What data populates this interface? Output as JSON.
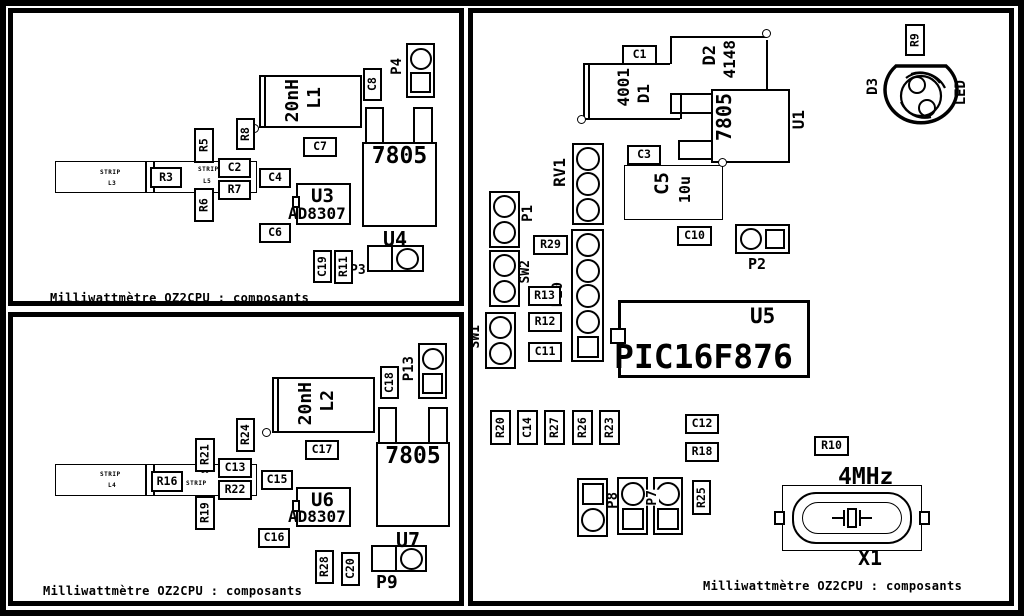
{
  "colors": {
    "line": "#000000",
    "background": "#ffffff"
  },
  "caption": "Milliwattmètre OZ2CPU : composants",
  "panel_tl": {
    "strip": {
      "line1": "STRIP",
      "line2": "L3"
    },
    "strip_small": {
      "line1": "STRIP",
      "line2": "L5"
    },
    "r3": "R3",
    "r5": "R5",
    "r6": "R6",
    "c2": "C2",
    "r7": "R7",
    "c4": "C4",
    "r8": "R8",
    "l1_value": "20nH",
    "l1_ref": "L1",
    "c7": "C7",
    "c8": "C8",
    "p4": "P4",
    "regulator": "7805",
    "u3_ref": "U3",
    "u3_value": "AD8307",
    "c6": "C6",
    "u4": "U4",
    "c19": "C19",
    "r11": "R11",
    "p3": "P3"
  },
  "panel_bl": {
    "strip": {
      "line1": "STRIP",
      "line2": "L4"
    },
    "strip_small": {
      "line1": "L6",
      "line2": "STRIP"
    },
    "r16": "R16",
    "r21": "R21",
    "r19": "R19",
    "c13": "C13",
    "r22": "R22",
    "r24": "R24",
    "c15": "C15",
    "l2_value": "20nH",
    "l2_ref": "L2",
    "c17": "C17",
    "c18": "C18",
    "p13": "P13",
    "regulator": "7805",
    "u6_ref": "U6",
    "u6_value": "AD8307",
    "c16": "C16",
    "u7": "U7",
    "r28": "R28",
    "c20": "C20",
    "p9": "P9"
  },
  "panel_right": {
    "c1": "C1",
    "d1_value": "4001",
    "d1_ref": "D1",
    "d2_ref": "D2",
    "d2_value": "4148",
    "u1_value": "7805",
    "u1_ref": "U1",
    "c3": "C3",
    "c5_ref": "C5",
    "c5_value": "10u",
    "c10": "C10",
    "p2": "P2",
    "r9": "R9",
    "d3_ref": "D3",
    "d3_value": "LED",
    "rv1": "RV1",
    "p10": "P10",
    "p1": "P1",
    "sw2": "SW2",
    "sw1": "SW1",
    "r29": "R29",
    "r13": "R13",
    "r12": "R12",
    "c11": "C11",
    "u5_ref": "U5",
    "u5_value": "PIC16F876",
    "r20": "R20",
    "c14": "C14",
    "r27": "R27",
    "r26": "R26",
    "r23": "R23",
    "c12": "C12",
    "r18": "R18",
    "p8": "P8",
    "p7": "P7",
    "r25": "R25",
    "r10": "R10",
    "x1_value": "4MHz",
    "x1_ref": "X1"
  }
}
